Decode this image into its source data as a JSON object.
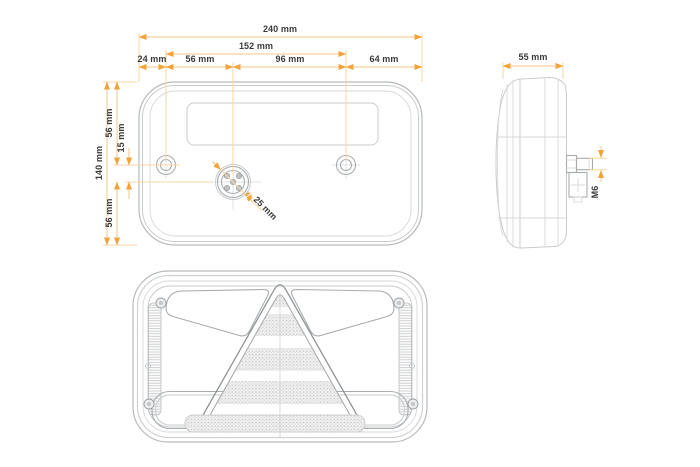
{
  "drawing": {
    "back_view": {
      "dims": {
        "total_width": "240 mm",
        "mount_hole_span": "152 mm",
        "edge_to_left_hole": "24 mm",
        "left_hole_to_connector": "56 mm",
        "connector_to_right_hole": "96 mm",
        "right_hole_to_edge": "64 mm",
        "total_height": "140 mm",
        "top_to_hole_row": "56 mm",
        "hole_row_to_connector": "15 mm",
        "connector_to_bottom": "56 mm",
        "connector_diameter_symbol": "⌀",
        "connector_diameter": "25 mm"
      }
    },
    "side_view": {
      "dims": {
        "depth": "55 mm",
        "mounting_stud_thread": "M6"
      }
    },
    "colors": {
      "dimension_line": "#F6C488",
      "dimension_arrow": "#F2A33C",
      "dimension_text": "#3A3A3A",
      "drawing_line_light": "#C9CCCE",
      "drawing_line_dark": "#8F9397"
    }
  }
}
